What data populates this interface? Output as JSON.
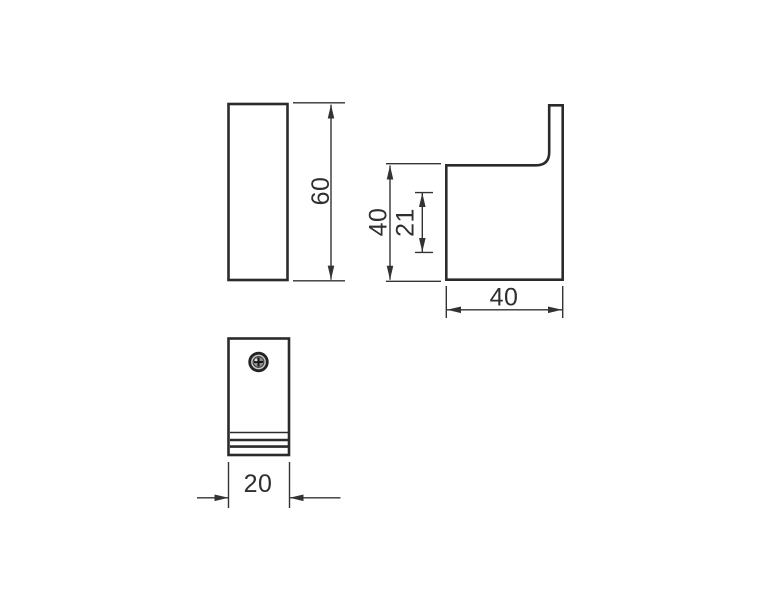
{
  "drawing": {
    "background": "#ffffff",
    "line_color": "#2b2b2b",
    "dimension_color": "#333333",
    "views": {
      "front": {
        "name": "front-view",
        "height_label": "60"
      },
      "side": {
        "name": "side-view",
        "height_label": "40",
        "inner_label": "21",
        "depth_label": "40"
      },
      "bottom": {
        "name": "bottom-view",
        "width_label": "20"
      }
    }
  }
}
